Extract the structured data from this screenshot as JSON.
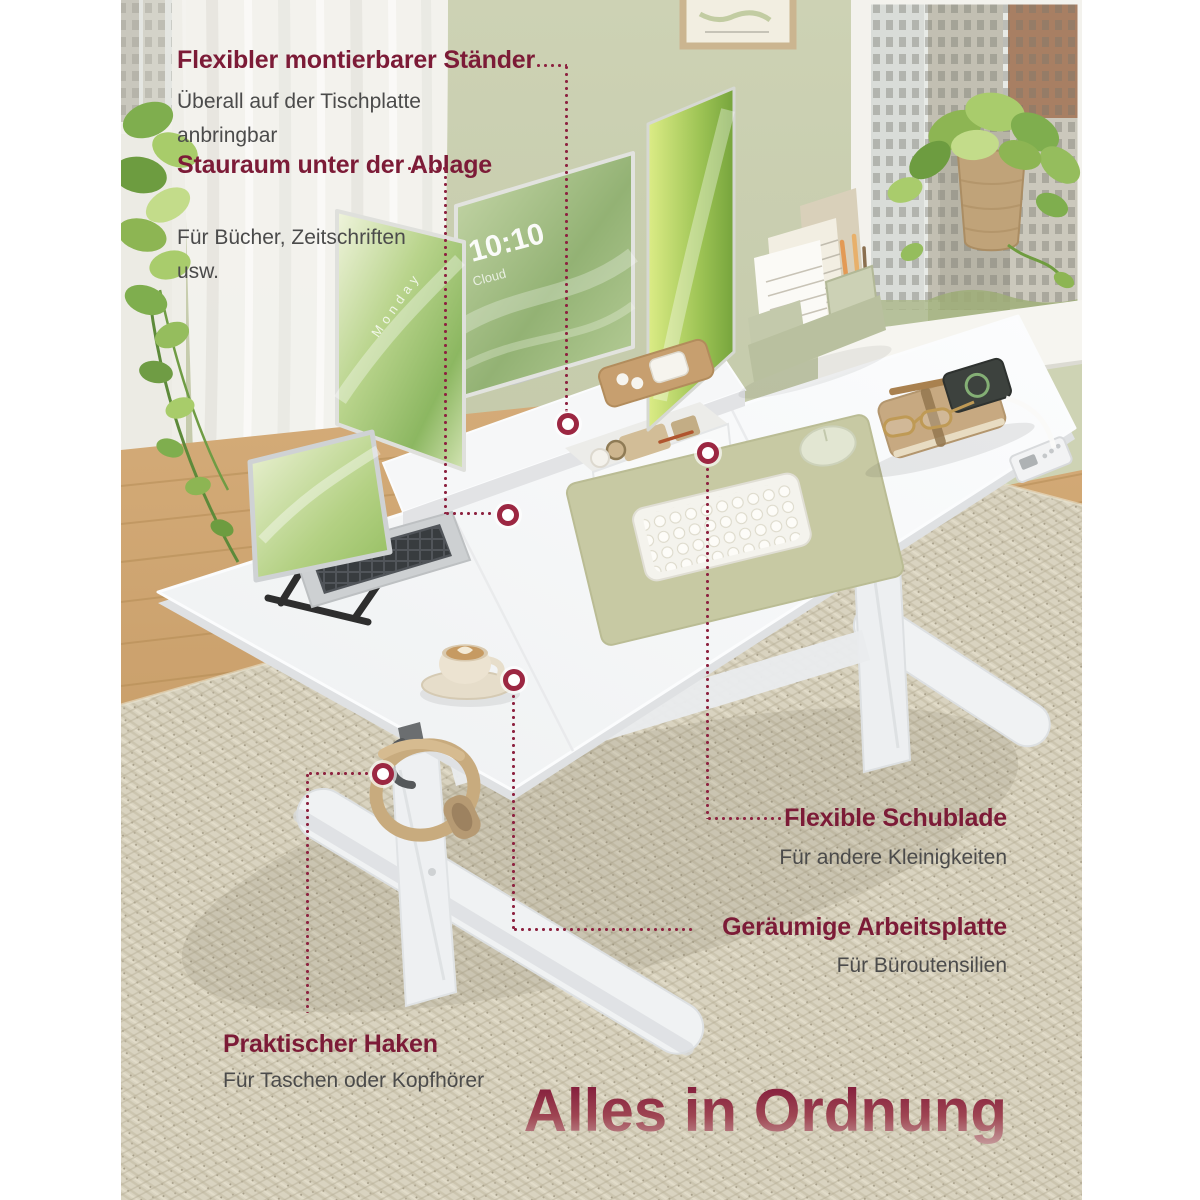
{
  "headline": {
    "text": "Alles in Ordnung"
  },
  "callouts": {
    "stand": {
      "title": "Flexibler montierbarer Ständer",
      "subtitle": "Überall auf der Tischplatte anbringbar"
    },
    "storage": {
      "title": "Stauraum unter der Ablage",
      "subtitle": "Für Bücher, Zeitschriften usw."
    },
    "drawer": {
      "title": "Flexible Schublade",
      "subtitle": "Für andere Kleinigkeiten"
    },
    "worktop": {
      "title": "Geräumige Arbeitsplatte",
      "subtitle": "Für Büroutensilien"
    },
    "hook": {
      "title": "Praktischer Haken",
      "subtitle": "Für Taschen oder Kopfhörer"
    }
  },
  "monitor_screen": {
    "time": "10:10",
    "weather": "Cloud",
    "day": "Monday"
  },
  "colors": {
    "accent_maroon": "#8d2240",
    "heading": "#7c1b37",
    "subtext": "#4b4b4b",
    "wall_green": "#c6cbac",
    "rug_beige": "#d9d3c0",
    "desk_white": "#f7f8f9",
    "headline_gradient_top": "#851e3c",
    "headline_gradient_bottom": "#c59a9b"
  }
}
